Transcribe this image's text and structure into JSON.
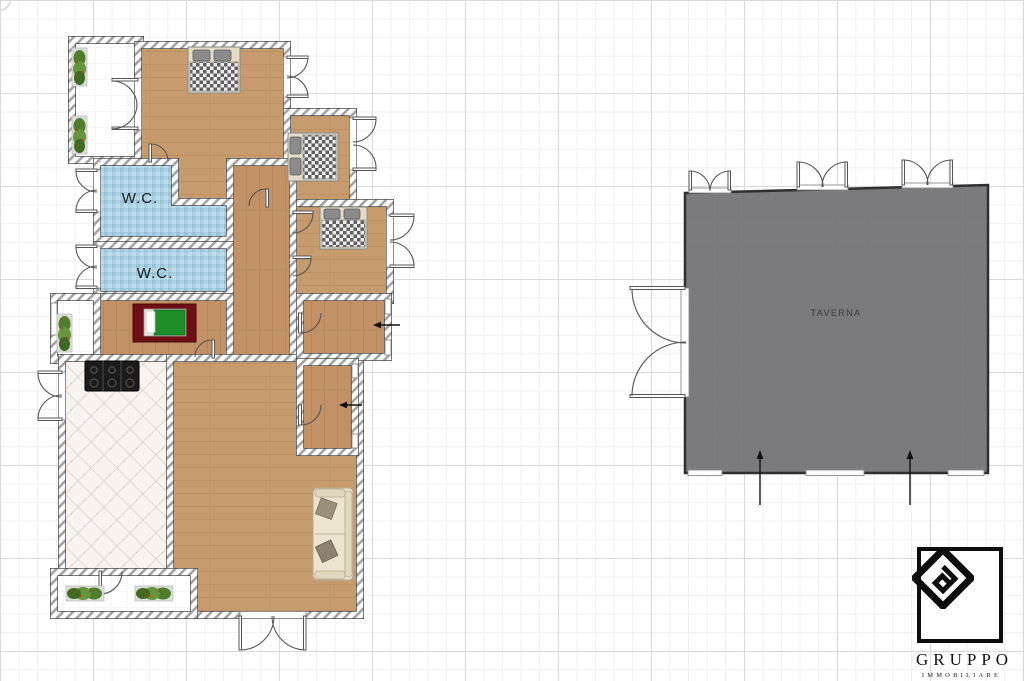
{
  "floorplan": {
    "apartment": {
      "wc1_label": "W.C.",
      "wc2_label": "W.C.",
      "rooms": [
        "balcony-top-left",
        "master-bedroom",
        "bedroom-2",
        "bedroom-3",
        "corridor",
        "wc-1",
        "wc-2",
        "rug-bedroom",
        "balcony-left",
        "kitchen",
        "living-room",
        "room-a",
        "room-b",
        "balcony-bottom"
      ]
    },
    "taverna": {
      "label": "TAVERNA"
    },
    "icons": {
      "double-bed-icon": "bed with checkered blanket and two pillows",
      "single-bed-icon": "green blanket bed with white pillow on dark red rug",
      "stove-icon": "black cooktop with burners",
      "sofa-icon": "cream sofa with two throw pillows",
      "plant-icon": "green potted plant in tray",
      "door-swing-icon": "quarter-circle door swing arc",
      "arrow-icon": "straight direction arrow"
    },
    "colors": {
      "grid_minor": "#efefef",
      "grid_major": "#d9d9d9",
      "wood_floor": "#c69b6e",
      "wood_floor_grain": "#b88e60",
      "wc_tile": "#aed2e4",
      "kitchen_tile": "#f9f3ed",
      "balcony_tile": "#ffffff",
      "taverna_fill": "#7b7b7e",
      "rug": "#6d0f13",
      "bed_green": "#1f8d2a",
      "wall_hatch_line": "#a3a3a3",
      "logo_black": "#0d0d0d"
    }
  },
  "logo": {
    "title": "GRUPPO",
    "subtitle": "IMMOBILIARE",
    "monogram": "FG"
  }
}
